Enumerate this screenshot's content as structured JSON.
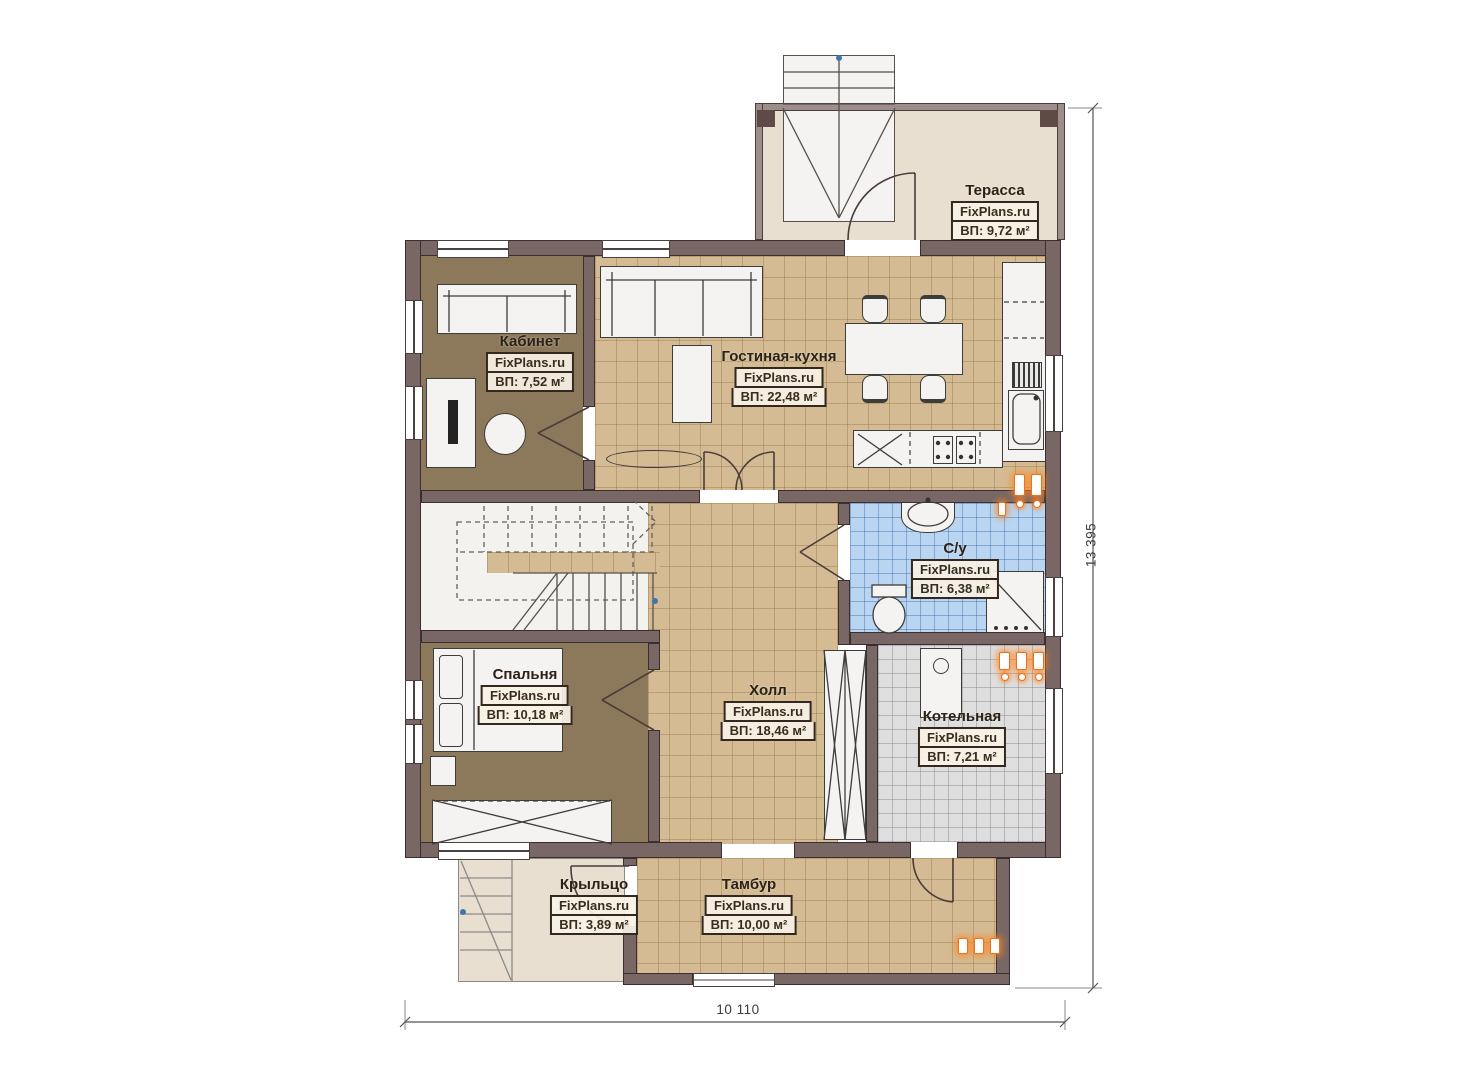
{
  "plan": {
    "watermark": "FixPlans.ru",
    "rooms": [
      {
        "id": "terrace",
        "name": "Терасса",
        "area": "ВП: 9,72 м²"
      },
      {
        "id": "office",
        "name": "Кабинет",
        "area": "ВП: 7,52 м²"
      },
      {
        "id": "living-kitchen",
        "name": "Гостиная-кухня",
        "area": "ВП: 22,48 м²"
      },
      {
        "id": "bathroom",
        "name": "С/у",
        "area": "ВП: 6,38 м²"
      },
      {
        "id": "bedroom",
        "name": "Спальня",
        "area": "ВП: 10,18 м²"
      },
      {
        "id": "hall",
        "name": "Холл",
        "area": "ВП: 18,46 м²"
      },
      {
        "id": "boiler",
        "name": "Котельная",
        "area": "ВП: 7,21 м²"
      },
      {
        "id": "porch",
        "name": "Крыльцо",
        "area": "ВП: 3,89 м²"
      },
      {
        "id": "vestibule",
        "name": "Тамбур",
        "area": "ВП: 10,00 м²"
      }
    ],
    "dimensions": {
      "width_mm": "10 110",
      "height_mm": "13 395"
    },
    "colors": {
      "wall": "#786765",
      "tile_tan": "#d4bb93",
      "tile_blue": "#b9d5f2",
      "tile_grey": "#dedede",
      "floor_wood": "#8c795b",
      "floor_beige": "#e9dfd0",
      "radiator_accent": "#e8731f"
    }
  }
}
